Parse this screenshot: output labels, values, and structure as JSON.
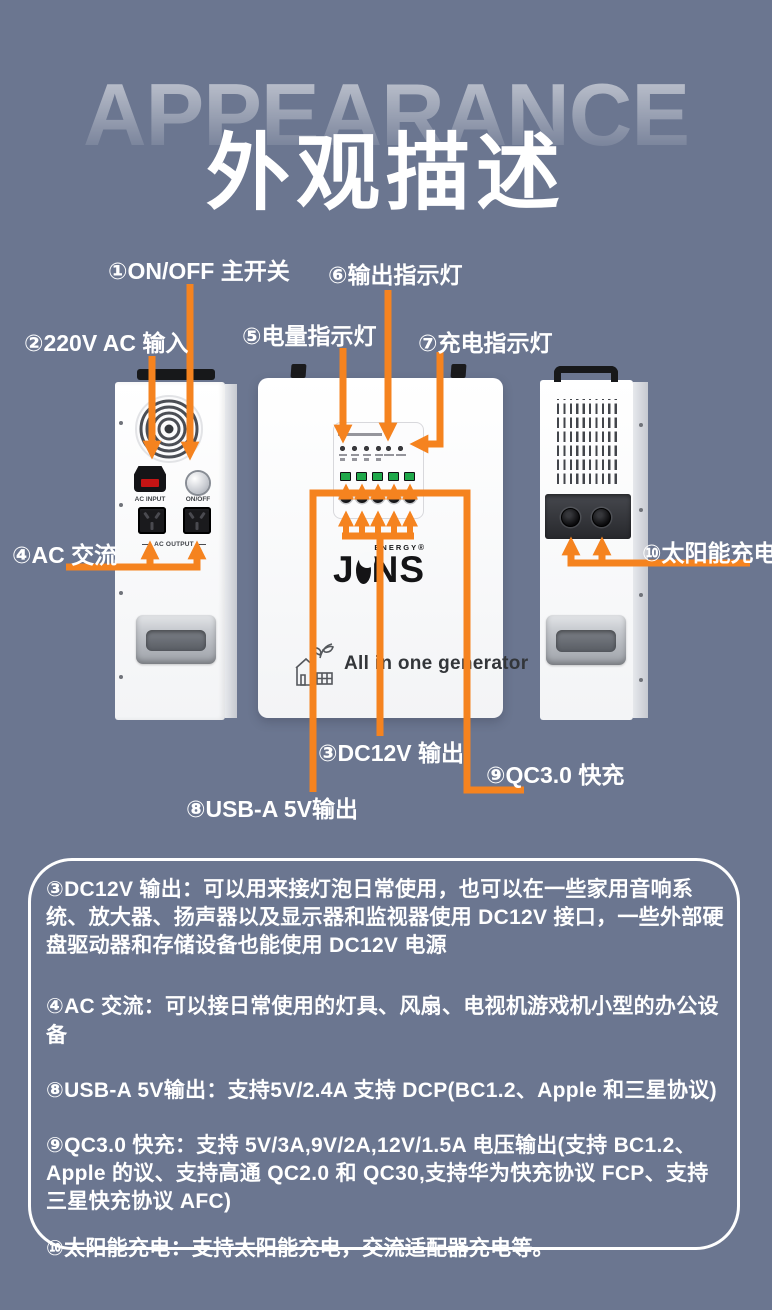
{
  "palette": {
    "background": "#6B7690",
    "accent_orange": "#F5831F",
    "usb_green": "#1FA84A",
    "device_white": "#FFFFFF"
  },
  "header": {
    "title_en": "APPEARANCE",
    "title_zh": "外观描述"
  },
  "callouts": [
    {
      "text": "①ON/OFF 主开关"
    },
    {
      "text": "②220V AC 输入"
    },
    {
      "text": "⑤电量指示灯"
    },
    {
      "text": "⑥输出指示灯"
    },
    {
      "text": "⑦充电指示灯"
    },
    {
      "text": "④AC 交流"
    },
    {
      "text": "⑩太阳能充电"
    },
    {
      "text": "③DC12V 输出"
    },
    {
      "text": "⑨QC3.0 快充"
    },
    {
      "text": "⑧USB-A 5V输出"
    }
  ],
  "left_device": {
    "ac_input_label": "AC INPUT",
    "power_label": "ON/OFF",
    "ac_output_label": "AC OUTPUT"
  },
  "front_device": {
    "brand_j": "J",
    "brand_ns": "NS",
    "brand_super": "ENERGY",
    "reg_mark": "®",
    "tagline": "All in one generator"
  },
  "descriptions": [
    {
      "text": "③DC12V 输出：可以用来接灯泡日常使用，也可以在一些家用音响系统、放大器、扬声器以及显示器和监视器使用 DC12V 接口，一些外部硬盘驱动器和存储设备也能使用 DC12V 电源"
    },
    {
      "text": "④AC 交流：可以接日常使用的灯具、风扇、电视机游戏机小型的办公设备"
    },
    {
      "text": "⑧USB-A 5V输出：支持5V/2.4A 支持 DCP(BC1.2、Apple 和三星协议)"
    },
    {
      "text": "⑨QC3.0 快充：支持 5V/3A,9V/2A,12V/1.5A 电压输出(支持 BC1.2、Apple 的议、支持高通 QC2.0 和 QC30,支持华为快充协议 FCP、支持三星快充协议 AFC)"
    },
    {
      "text": "⑩太阳能充电：支持太阳能充电，交流适配器充电等。"
    }
  ]
}
